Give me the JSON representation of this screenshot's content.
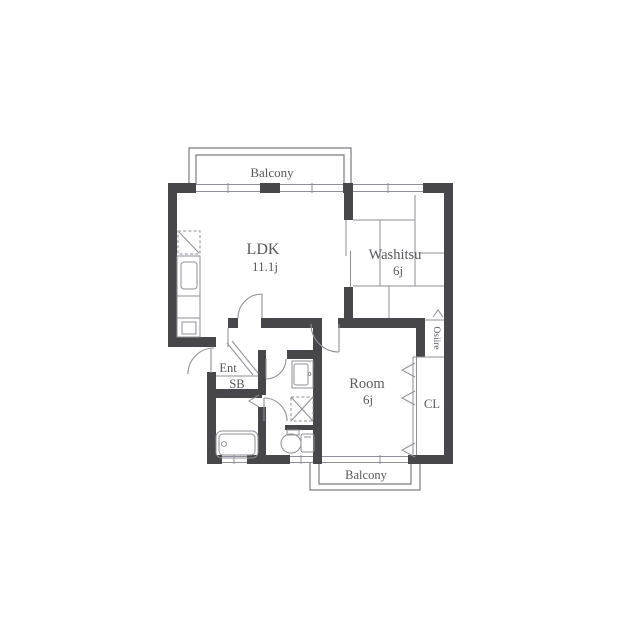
{
  "floorplan": {
    "title": "2DK apartment floor plan",
    "rooms": {
      "balcony_top": {
        "label": "Balcony"
      },
      "ldk": {
        "label": "LDK",
        "size": "11.1j"
      },
      "washitsu": {
        "label": "Washitsu",
        "size": "6j"
      },
      "room": {
        "label": "Room",
        "size": "6j"
      },
      "entrance": {
        "label": "Ent"
      },
      "shoebox": {
        "label": "SB"
      },
      "oshiire": {
        "label": "Osiire"
      },
      "closet": {
        "label": "CL"
      },
      "balcony_bottom": {
        "label": "Balcony"
      }
    },
    "symbols": [
      "refrigerator",
      "kitchen-counter",
      "kitchen-sink",
      "sliding-door",
      "vanity-sink",
      "washing-machine",
      "bathtub",
      "toilet",
      "closet-folding-chevrons",
      "oshiire-caret",
      "door-swing-arcs",
      "windows"
    ],
    "colors": {
      "wall": "#47474b",
      "line": "#8f8f97",
      "balcony_line": "#7a7a82",
      "text": "#58585c",
      "background": "#ffffff"
    }
  }
}
